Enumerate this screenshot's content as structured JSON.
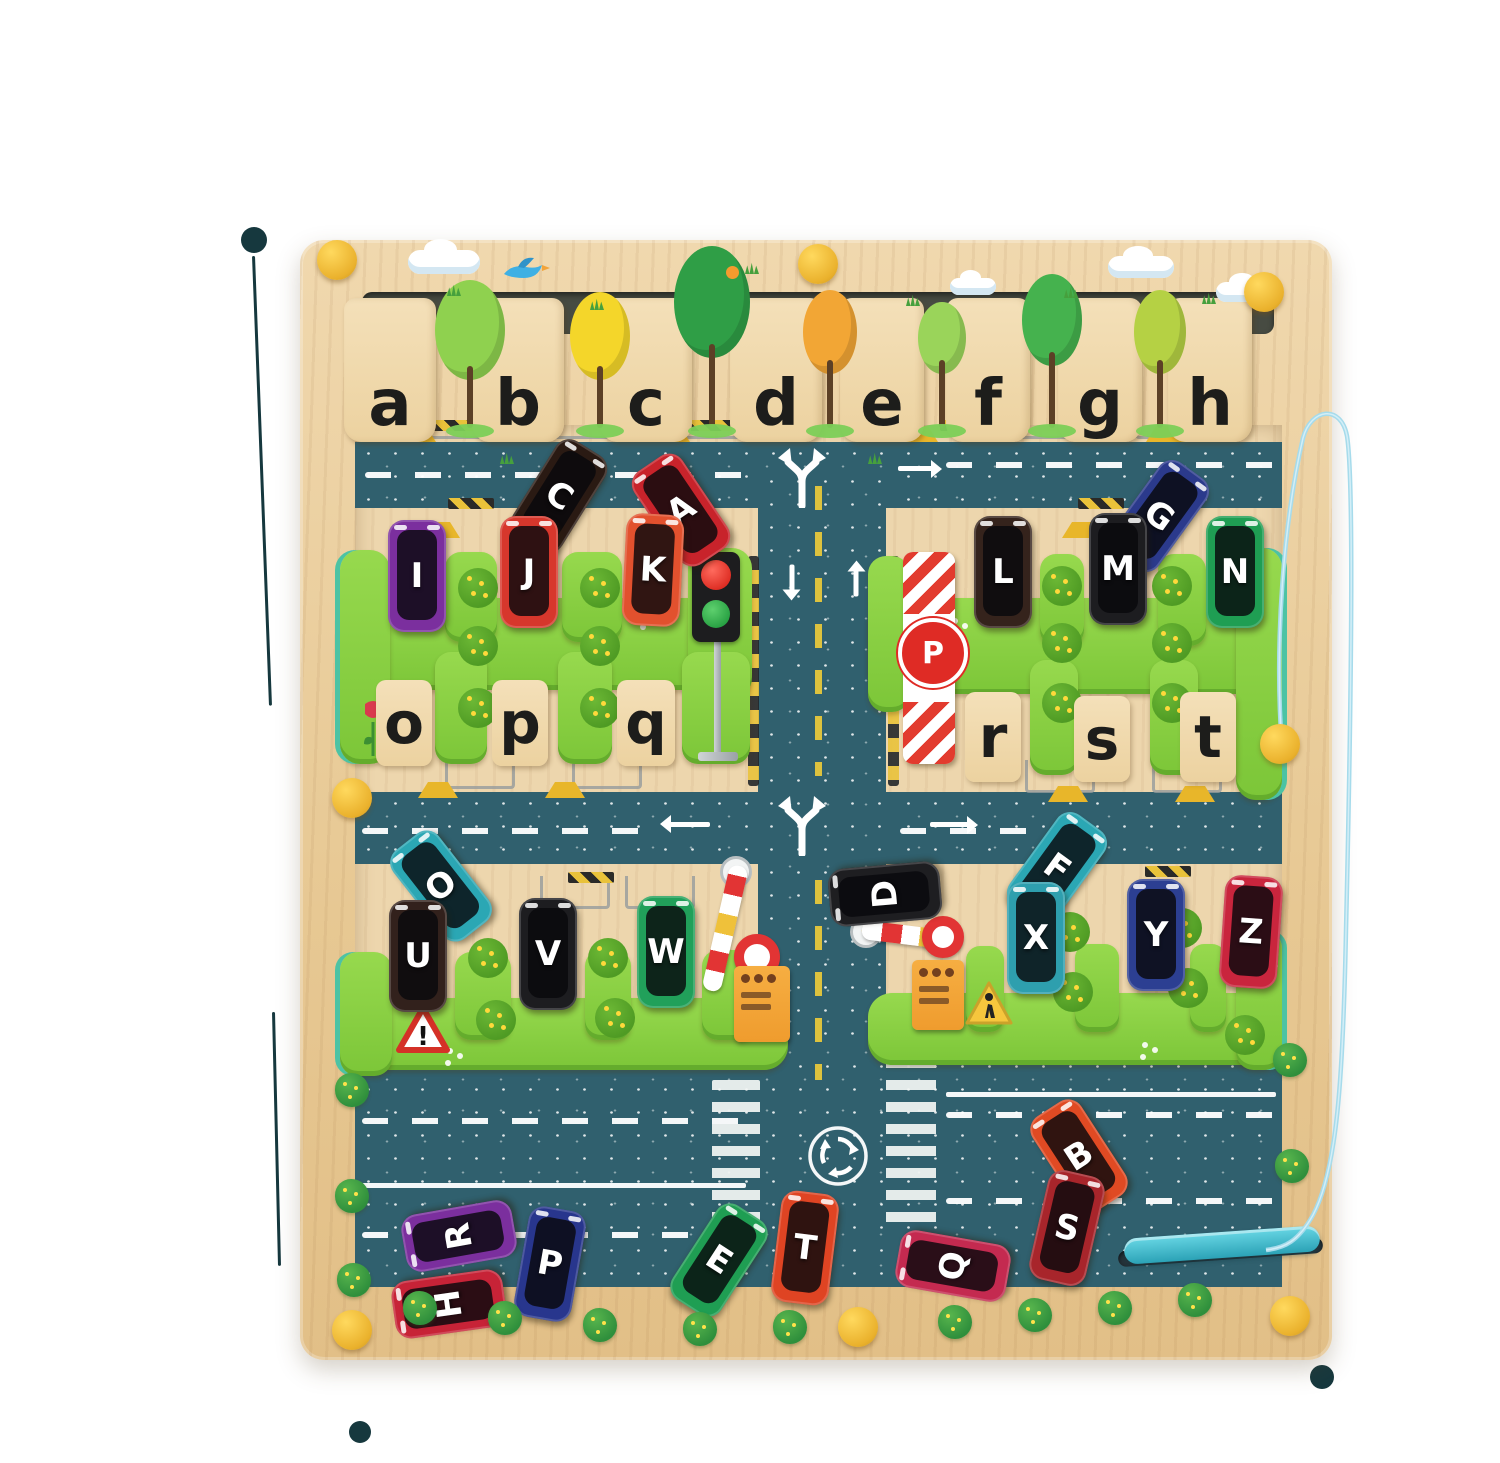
{
  "scene": {
    "name": "alphabet-traffic-maze-board-photo"
  },
  "signs": {
    "parking": "P",
    "warning": "!"
  },
  "colors": {
    "wood": "#ecd3a7",
    "wood_light": "#f2ddb6",
    "road": "#30606e",
    "hedge": "#86cf43",
    "hedge_bump": "#57aa2b",
    "glitter_edge": "#4cc3a4",
    "knob": "#f2bc37",
    "cord": "#a6dbeb",
    "stylus": "#3ec3d3",
    "dash_yellow": "#e6c73c",
    "mark": "#16383e"
  },
  "top_tabs": [
    {
      "label": "a",
      "x": 390,
      "w": 92
    },
    {
      "label": "b",
      "x": 518,
      "w": 92
    },
    {
      "label": "c",
      "x": 646,
      "w": 92
    },
    {
      "label": "d",
      "x": 776,
      "w": 92
    },
    {
      "label": "e",
      "x": 882,
      "w": 84
    },
    {
      "label": "f",
      "x": 988,
      "w": 84
    },
    {
      "label": "g",
      "x": 1100,
      "w": 84
    },
    {
      "label": "h",
      "x": 1210,
      "w": 84
    }
  ],
  "mid_tabs": [
    {
      "label": "o",
      "x": 376,
      "y": 680,
      "w": 56,
      "h": 86
    },
    {
      "label": "p",
      "x": 492,
      "y": 680,
      "w": 56,
      "h": 86
    },
    {
      "label": "q",
      "x": 617,
      "y": 680,
      "w": 58,
      "h": 86
    },
    {
      "label": "r",
      "x": 965,
      "y": 692,
      "w": 56,
      "h": 90
    },
    {
      "label": "s",
      "x": 1074,
      "y": 696,
      "w": 56,
      "h": 86
    },
    {
      "label": "t",
      "x": 1180,
      "y": 692,
      "w": 56,
      "h": 90
    }
  ],
  "cars": [
    {
      "letter": "C",
      "color": "#2a1a13",
      "x": 530,
      "y": 440,
      "rot": 32
    },
    {
      "letter": "A",
      "color": "#c8232b",
      "x": 652,
      "y": 454,
      "rot": -34
    },
    {
      "letter": "G",
      "color": "#2b3a8c",
      "x": 1130,
      "y": 460,
      "rot": 36
    },
    {
      "letter": "I",
      "color": "#7b2f9e",
      "x": 388,
      "y": 520,
      "rot": 0
    },
    {
      "letter": "J",
      "color": "#d7372c",
      "x": 500,
      "y": 516,
      "rot": 0
    },
    {
      "letter": "K",
      "color": "#e2512e",
      "x": 624,
      "y": 514,
      "rot": 3
    },
    {
      "letter": "L",
      "color": "#35231c",
      "x": 974,
      "y": 516,
      "rot": 0
    },
    {
      "letter": "M",
      "color": "#1d1d20",
      "x": 1089,
      "y": 513,
      "rot": 0
    },
    {
      "letter": "N",
      "color": "#1f9e53",
      "x": 1206,
      "y": 516,
      "rot": 0
    },
    {
      "letter": "O",
      "color": "#2ba7b4",
      "x": 412,
      "y": 830,
      "rot": -38
    },
    {
      "letter": "U",
      "color": "#32211c",
      "x": 389,
      "y": 900,
      "rot": 0
    },
    {
      "letter": "V",
      "color": "#1d1d20",
      "x": 519,
      "y": 898,
      "rot": 0
    },
    {
      "letter": "W",
      "color": "#21a05a",
      "x": 637,
      "y": 896,
      "rot": 0
    },
    {
      "letter": "D",
      "color": "#1e1e21",
      "x": 856,
      "y": 838,
      "rot": -95
    },
    {
      "letter": "F",
      "color": "#2ba7b4",
      "x": 1028,
      "y": 812,
      "rot": 36
    },
    {
      "letter": "X",
      "color": "#2e9fae",
      "x": 1007,
      "y": 882,
      "rot": 0
    },
    {
      "letter": "Y",
      "color": "#2c3f92",
      "x": 1127,
      "y": 879,
      "rot": 0
    },
    {
      "letter": "Z",
      "color": "#c9253d",
      "x": 1222,
      "y": 876,
      "rot": 4
    },
    {
      "letter": "R",
      "color": "#7b2f9e",
      "x": 430,
      "y": 1180,
      "rot": -100
    },
    {
      "letter": "P",
      "color": "#28368d",
      "x": 521,
      "y": 1208,
      "rot": 10
    },
    {
      "letter": "H",
      "color": "#c72337",
      "x": 420,
      "y": 1248,
      "rot": -98
    },
    {
      "letter": "E",
      "color": "#1f9e53",
      "x": 690,
      "y": 1204,
      "rot": 33
    },
    {
      "letter": "T",
      "color": "#df4423",
      "x": 776,
      "y": 1192,
      "rot": 7
    },
    {
      "letter": "B",
      "color": "#e04a23",
      "x": 1050,
      "y": 1100,
      "rot": -33
    },
    {
      "letter": "S",
      "color": "#a8252b",
      "x": 1038,
      "y": 1172,
      "rot": 13
    },
    {
      "letter": "Q",
      "color": "#c42a50",
      "x": 924,
      "y": 1210,
      "rot": -80
    }
  ],
  "trees": [
    {
      "x": 470,
      "y": 330,
      "rx": 35,
      "ry": 50,
      "color": "#8fd14f"
    },
    {
      "x": 600,
      "y": 336,
      "rx": 30,
      "ry": 44,
      "color": "#f4d62a"
    },
    {
      "x": 712,
      "y": 302,
      "rx": 38,
      "ry": 56,
      "color": "#2f9e46"
    },
    {
      "x": 830,
      "y": 332,
      "rx": 27,
      "ry": 42,
      "color": "#f2a635"
    },
    {
      "x": 942,
      "y": 338,
      "rx": 24,
      "ry": 36,
      "color": "#9ad45a"
    },
    {
      "x": 1052,
      "y": 320,
      "rx": 30,
      "ry": 46,
      "color": "#45b24e"
    },
    {
      "x": 1160,
      "y": 332,
      "rx": 26,
      "ry": 42,
      "color": "#b5d144"
    }
  ],
  "clouds": [
    [
      408,
      250,
      72,
      24
    ],
    [
      950,
      278,
      46,
      17
    ],
    [
      1108,
      256,
      66,
      22
    ],
    [
      1216,
      282,
      58,
      20
    ]
  ],
  "sprouts": [
    [
      447,
      284
    ],
    [
      590,
      298
    ],
    [
      745,
      262
    ],
    [
      906,
      294
    ],
    [
      1064,
      286
    ],
    [
      1202,
      292
    ],
    [
      868,
      452
    ],
    [
      500,
      452
    ]
  ],
  "knobs": [
    [
      337,
      260
    ],
    [
      818,
      264
    ],
    [
      1264,
      292
    ],
    [
      352,
      798
    ],
    [
      1280,
      744
    ],
    [
      352,
      1330
    ],
    [
      858,
      1327
    ],
    [
      1290,
      1316
    ]
  ],
  "bushes": [
    [
      352,
      1090
    ],
    [
      352,
      1196
    ],
    [
      354,
      1280
    ],
    [
      420,
      1308
    ],
    [
      505,
      1318
    ],
    [
      600,
      1325
    ],
    [
      700,
      1329
    ],
    [
      790,
      1327
    ],
    [
      955,
      1322
    ],
    [
      1035,
      1315
    ],
    [
      1115,
      1308
    ],
    [
      1195,
      1300
    ],
    [
      1290,
      1060
    ],
    [
      1292,
      1166
    ]
  ],
  "bumps": [
    [
      478,
      588
    ],
    [
      600,
      588
    ],
    [
      478,
      646
    ],
    [
      600,
      646
    ],
    [
      478,
      708
    ],
    [
      600,
      708
    ],
    [
      1062,
      586
    ],
    [
      1172,
      586
    ],
    [
      1062,
      643
    ],
    [
      1172,
      643
    ],
    [
      1062,
      703
    ],
    [
      1172,
      703
    ],
    [
      488,
      958
    ],
    [
      608,
      958
    ],
    [
      496,
      1020
    ],
    [
      615,
      1018
    ],
    [
      1070,
      932
    ],
    [
      1182,
      928
    ],
    [
      1073,
      992
    ],
    [
      1188,
      988
    ],
    [
      1245,
      1035
    ]
  ],
  "flowers": [
    [
      412,
      600
    ],
    [
      642,
      612
    ],
    [
      952,
      618
    ],
    [
      1228,
      600
    ],
    [
      447,
      1048
    ],
    [
      747,
      1000
    ],
    [
      1142,
      1042
    ],
    [
      1262,
      958
    ],
    [
      1092,
      560
    ]
  ],
  "photo_marks": {
    "dots": [
      [
        254,
        240,
        13
      ],
      [
        360,
        1432,
        11
      ],
      [
        1322,
        1377,
        12
      ]
    ],
    "lines": [
      [
        252,
        256,
        269,
        706
      ],
      [
        272,
        1012,
        278,
        1266
      ]
    ]
  }
}
